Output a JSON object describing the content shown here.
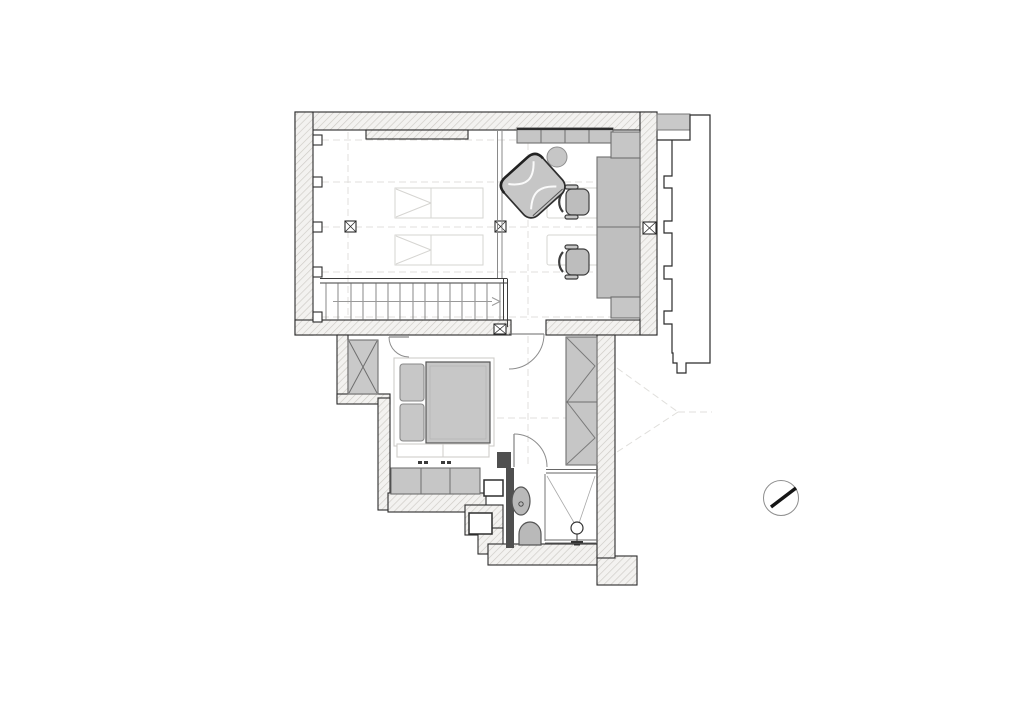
{
  "document": {
    "kind": "architectural floor plan",
    "view": "top-down plan drawing on white sheet"
  },
  "colors": {
    "paper": "#ffffff",
    "ink": "#2b2b2b",
    "wall_fill": "#f3f2f0",
    "hatch_line": "#cdcac5",
    "dark_wall": "#4f4f4f",
    "party_wall": "#c9c9c9",
    "furniture": "#c6c6c6",
    "desk": "#bfbfbf",
    "seat": "#bdbdbd",
    "mattress": "#c7c7c7",
    "fixture": "#b9b9b9",
    "light_line": "#d6d5d2",
    "guide": "#e0dfdc",
    "glass": "#8a8a8a"
  },
  "stair": {
    "tread_count": 15,
    "direction_arrow": "right"
  },
  "compass": {
    "needle_angle_deg": -38
  }
}
